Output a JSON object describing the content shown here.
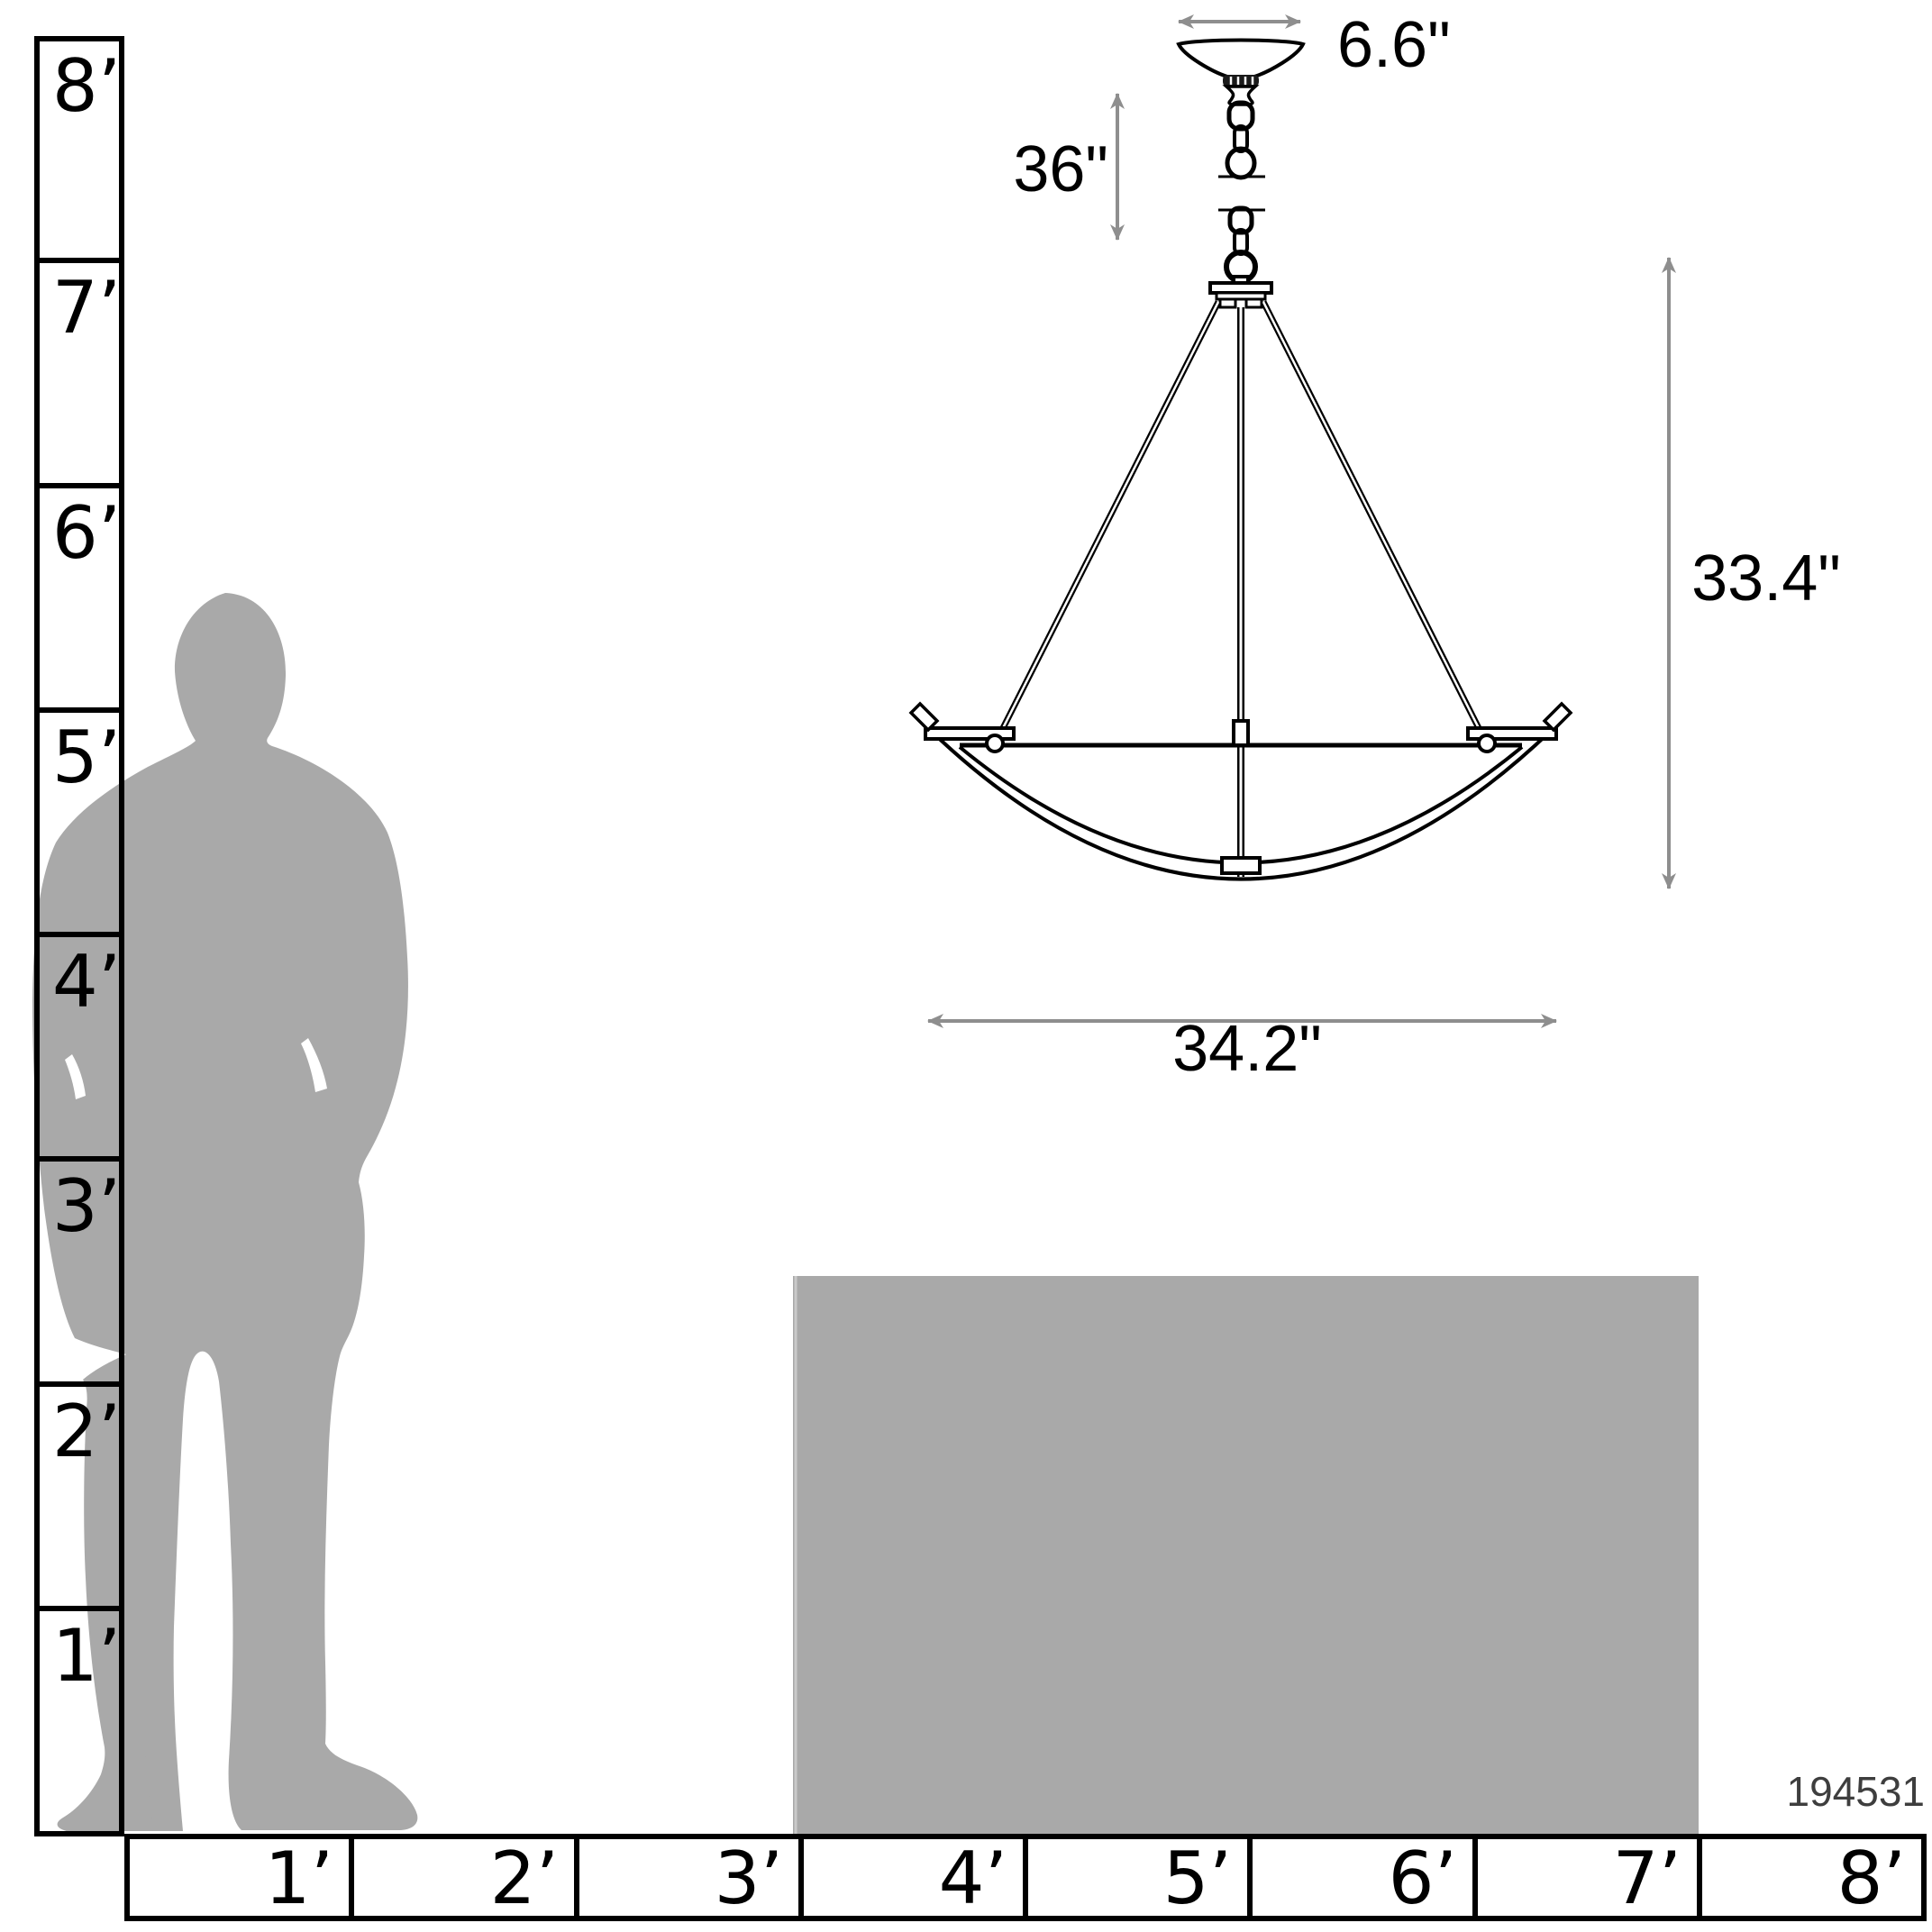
{
  "diagram": {
    "title": "pendant-light-scale-diagram",
    "product_code": "194531",
    "dimension_labels": {
      "canopy_width": "6.6\"",
      "chain_length": "36\"",
      "fixture_height": "33.4\"",
      "fixture_width": "34.2\""
    },
    "vertical_ruler": {
      "unit": "feet",
      "labels": [
        "8’",
        "7’",
        "6’",
        "5’",
        "4’",
        "3’",
        "2’",
        "1’"
      ]
    },
    "horizontal_ruler": {
      "unit": "feet",
      "labels": [
        "1’",
        "2’",
        "3’",
        "4’",
        "5’",
        "6’",
        "7’",
        "8’"
      ]
    },
    "colors": {
      "line_art": "#000000",
      "dimension_arrow": "#8e8e8e",
      "silhouette": "#a9a9a9",
      "table": "#a9a9a9",
      "product_code_text": "#3e3e3e"
    }
  }
}
